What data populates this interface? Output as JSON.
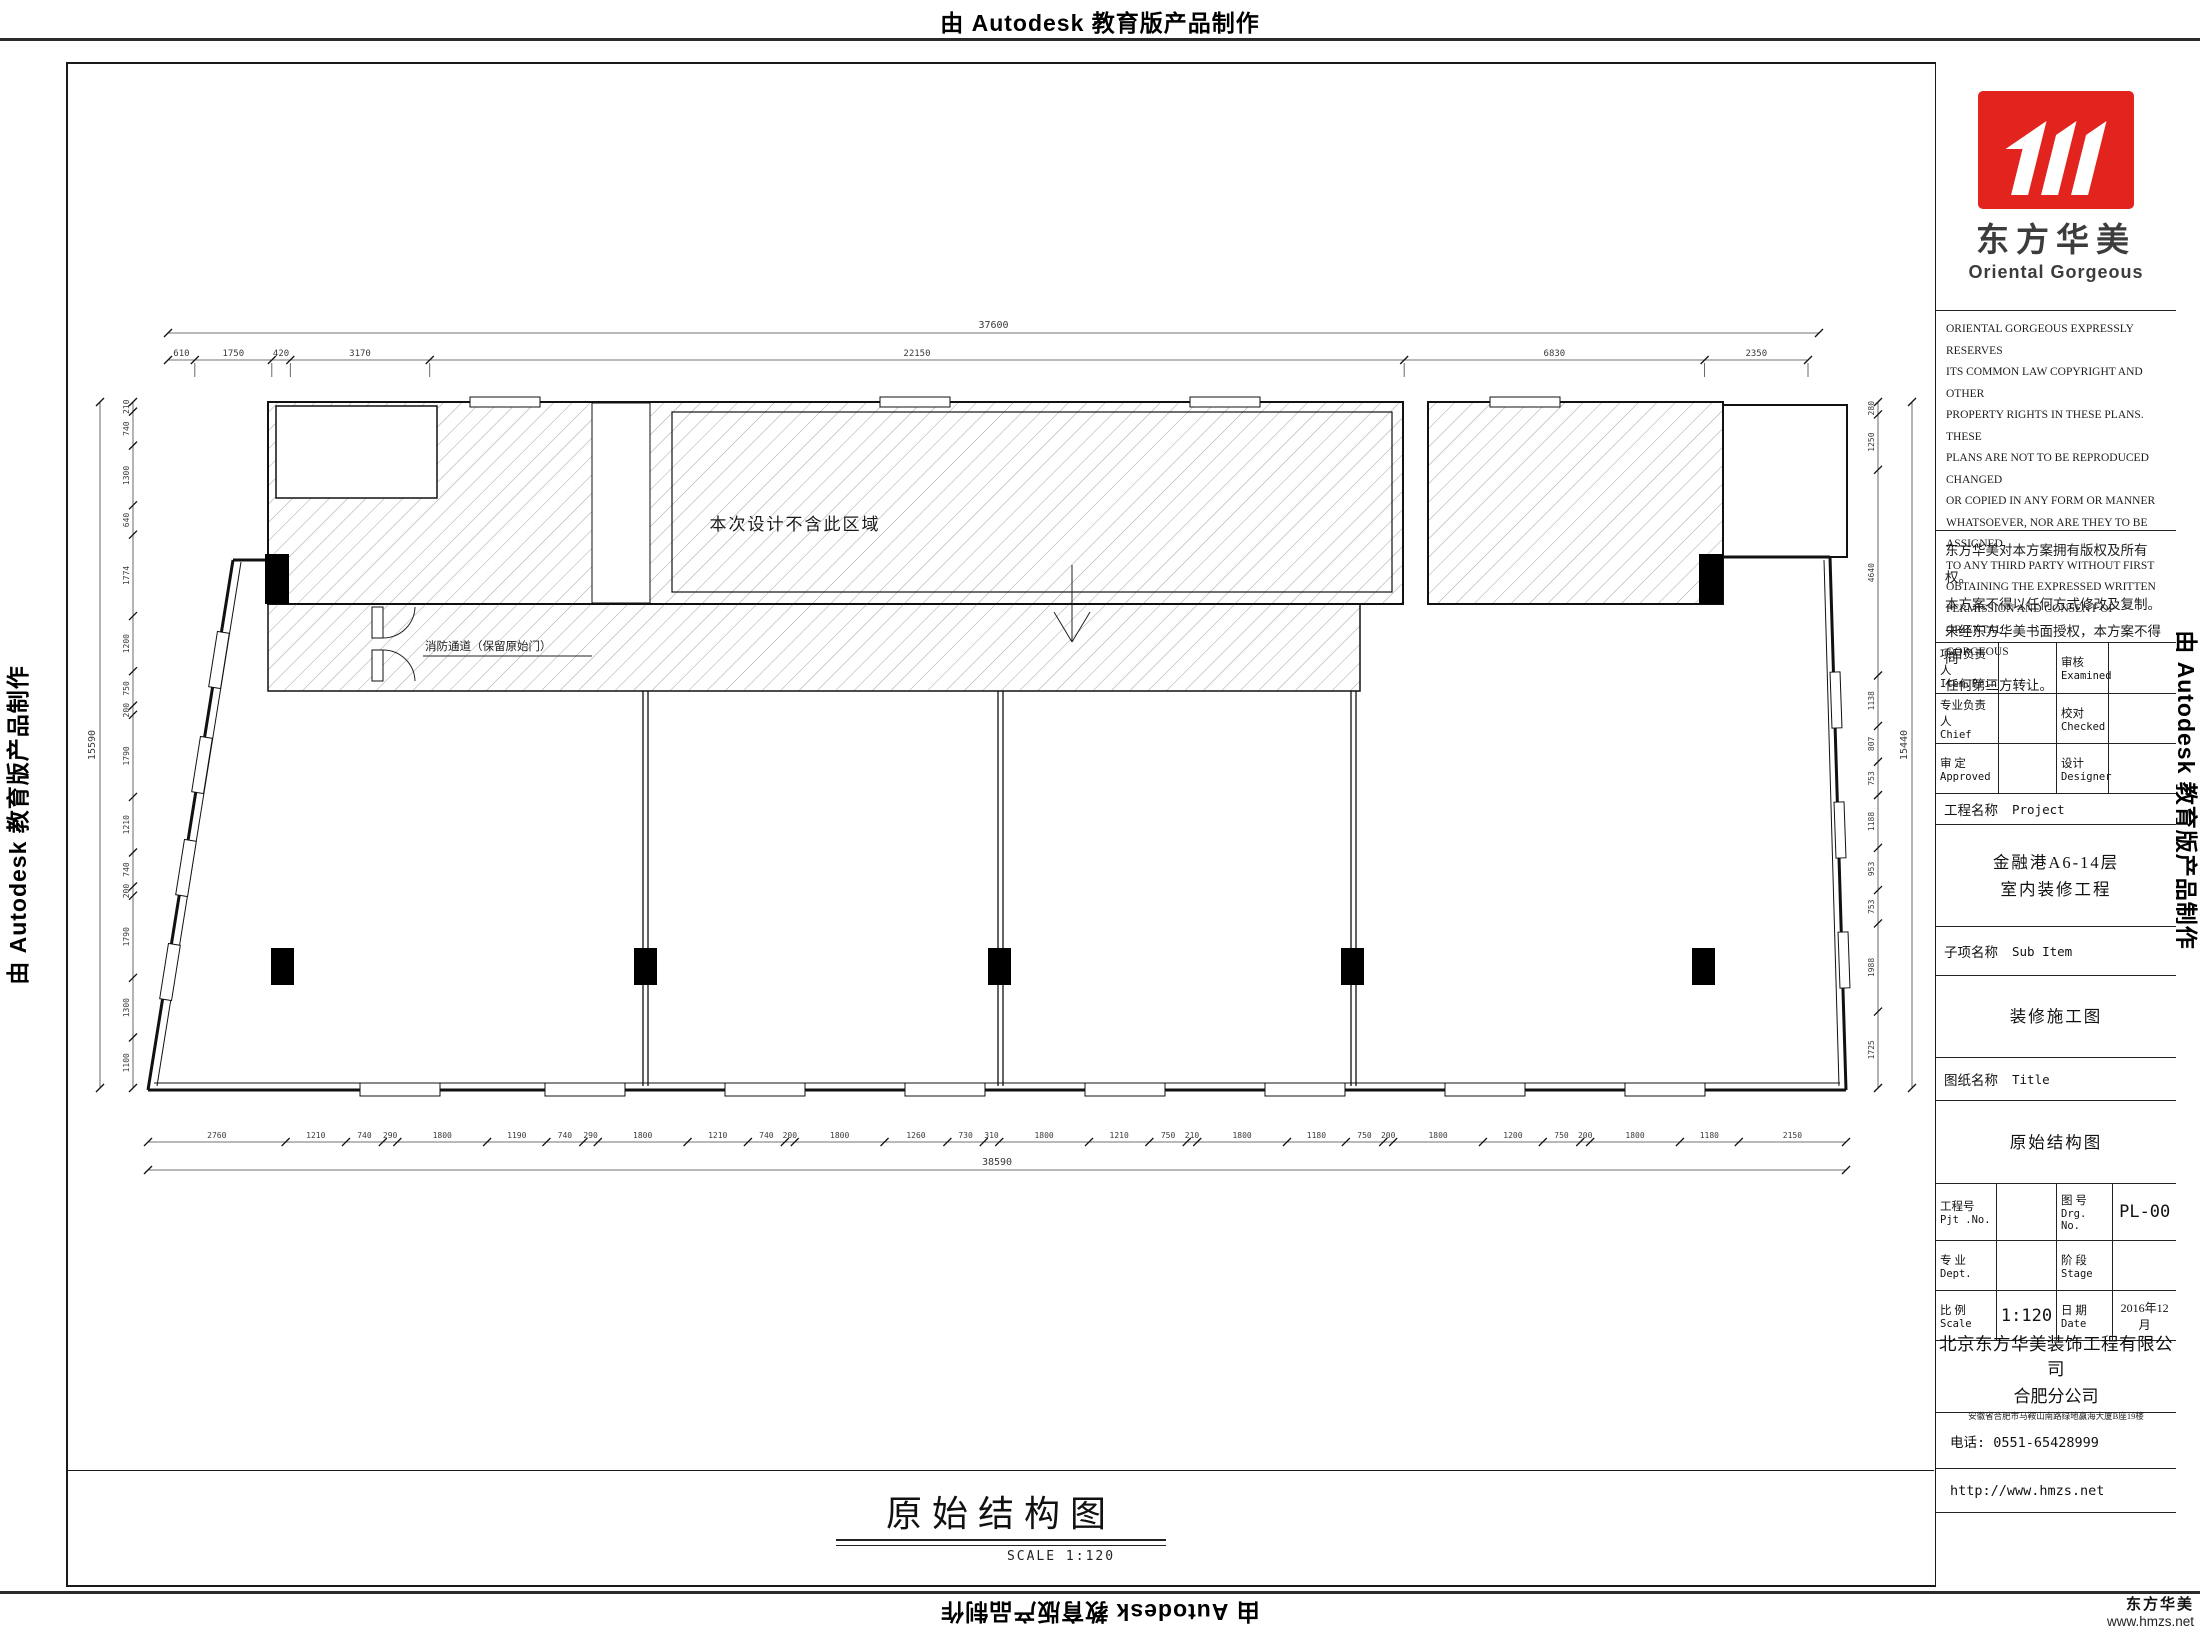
{
  "banners": {
    "autodesk": "由 Autodesk 教育版产品制作"
  },
  "plan": {
    "note_region": "本次设计不含此区域",
    "note_corridor": "消防通道（保留原始门）",
    "dim_top_total": "37600",
    "dim_top": [
      "610",
      "1750",
      "420",
      "3170",
      "22150",
      "6830",
      "2350"
    ],
    "dim_bottom": [
      "2760",
      "1210",
      "740",
      "290",
      "1800",
      "1190",
      "740",
      "290",
      "1800",
      "1210",
      "740",
      "200",
      "1800",
      "1260",
      "730",
      "310",
      "1800",
      "1210",
      "750",
      "210",
      "1800",
      "1180",
      "750",
      "200",
      "1800",
      "1200",
      "750",
      "200",
      "1800",
      "1180",
      "2150"
    ],
    "dim_bottom_total": "38590",
    "dim_left": [
      "210",
      "740",
      "1300",
      "640",
      "1774",
      "1200",
      "750",
      "200",
      "1790",
      "1210",
      "740",
      "200",
      "1790",
      "1300",
      "1100"
    ],
    "dim_left_total": "15590",
    "dim_right": [
      "280",
      "1250",
      "4640",
      "1138",
      "807",
      "753",
      "1188",
      "953",
      "753",
      "1988",
      "1725"
    ],
    "dim_right_total": "15440"
  },
  "drawing_title": {
    "text": "原始结构图",
    "scale_label": "SCALE  1:120"
  },
  "titleblock": {
    "logo": {
      "cn": "东方华美",
      "en": "Oriental  Gorgeous",
      "red": "#e3231d"
    },
    "copyright_en": "ORIENTAL GORGEOUS EXPRESSLY RESERVES\nITS COMMON LAW COPYRIGHT AND OTHER\nPROPERTY RIGHTS IN THESE PLANS. THESE\nPLANS ARE NOT TO BE REPRODUCED CHANGED\nOR COPIED IN ANY FORM OR MANNER\nWHATSOEVER, NOR ARE THEY TO BE ASSIGNED\nTO ANY THIRD PARTY WITHOUT FIRST\nOBTAINING THE EXPRESSED WRITTEN\nPERMISSION AND CONSENT OF ORIENTAL\nGORGEOUS",
    "copyright_cn": "东方华美对本方案拥有版权及所有权。\n本方案不得以任何方式修改及复制。\n未经东方华美书面授权，本方案不得向\n任何第三方转让。",
    "personnel": {
      "rows": [
        {
          "l1": "项目负责人",
          "l2": "Item.Prin",
          "r1": "审核",
          "r2": "Examined"
        },
        {
          "l1": "专业负责人",
          "l2": "Chief",
          "r1": "校对",
          "r2": "Checked"
        },
        {
          "l1": "审 定",
          "l2": "Approved",
          "r1": "设计",
          "r2": "Designer"
        }
      ]
    },
    "project_label": {
      "cn": "工程名称",
      "en": "Project"
    },
    "project_name": "金融港A6-14层\n室内装修工程",
    "subitem_label": {
      "cn": "子项名称",
      "en": "Sub Item"
    },
    "subitem_value": "装修施工图",
    "sheet_label": {
      "cn": "图纸名称",
      "en": "Title"
    },
    "sheet_value": "原始结构图",
    "grid": {
      "pjt_cn": "工程号",
      "pjt_en": "Pjt .No.",
      "pjt_val": "",
      "drg_cn": "图 号",
      "drg_en": "Drg. No.",
      "drg_val": "PL-00",
      "dept_cn": "专 业",
      "dept_en": "Dept.",
      "dept_val": "",
      "stage_cn": "阶 段",
      "stage_en": "Stage",
      "stage_val": "",
      "scale_cn": "比 例",
      "scale_en": "Scale",
      "scale_val": "1:120",
      "date_cn": "日 期",
      "date_en": "Date",
      "date_val": "2016年12月"
    },
    "company_line1": "北京东方华美装饰工程有限公司",
    "company_line2": "合肥分公司",
    "company_address": "安徽省合肥市马鞍山南路绿地赢海大厦B座19楼",
    "phone": "电话: 0551-65428999",
    "website": "http://www.hmzs.net"
  },
  "watermark": {
    "brand": "东方华美",
    "site": "www.hmzs.net"
  }
}
